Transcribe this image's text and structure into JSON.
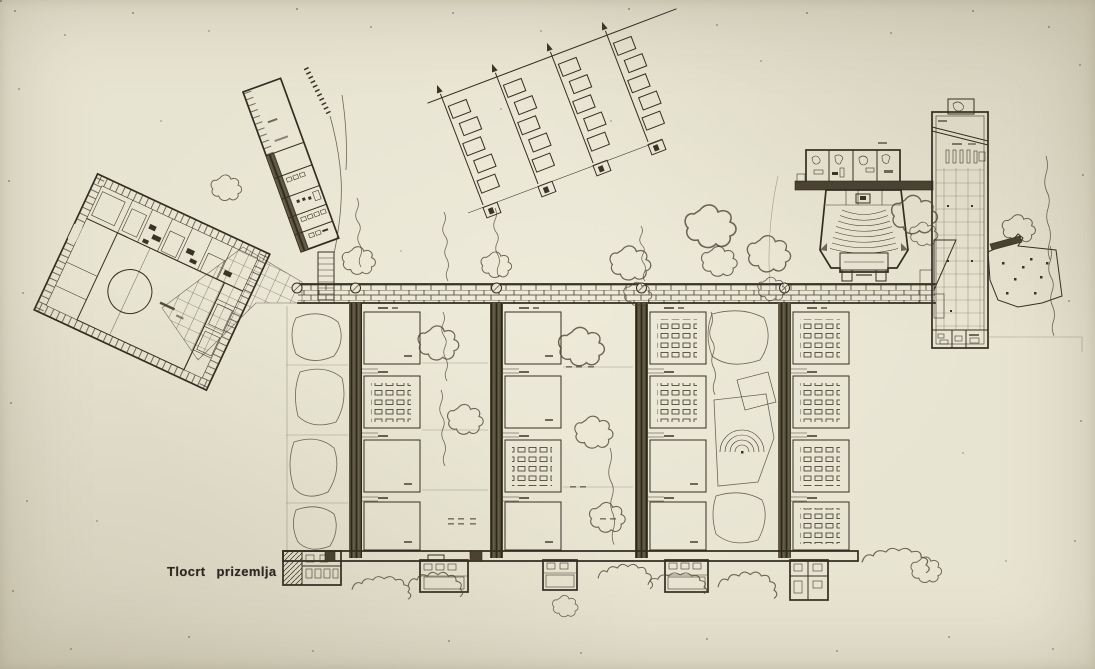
{
  "caption": {
    "text": "Tlocrt prizemlja"
  },
  "colors": {
    "paper": "#e8e4d2",
    "ink": "#322d22"
  }
}
